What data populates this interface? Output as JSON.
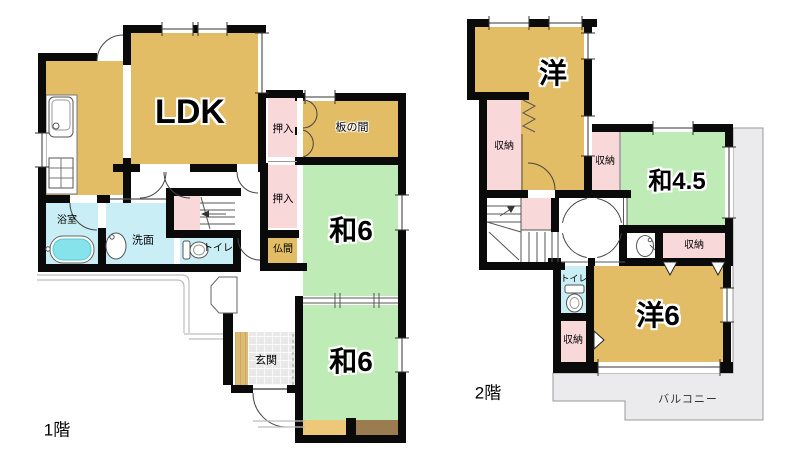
{
  "colors": {
    "wall": "#0a0a0a",
    "wood_tan": "#e3bc66",
    "tatami_green": "#bfecb6",
    "closet_pink": "#f9d8da",
    "wet_room_cyan": "#c9eef5",
    "bathtub_cyan": "#86e3eb",
    "balcony_gray": "#ebebed",
    "entrance_tile_gray": "#e9e9e9",
    "wood_strip_brown": "#9b7c50"
  },
  "floor1": {
    "floor_label": "1階",
    "rooms": {
      "ldk": "LDK",
      "itanoma": "板の間",
      "oshiire_upper": "押入",
      "oshiire_lower": "押入",
      "washitsu_east": "和6",
      "washitsu_south": "和6",
      "butsuma": "仏間",
      "bathroom": "浴室",
      "washroom": "洗面",
      "toilet": "トイレ",
      "genkan": "玄関"
    }
  },
  "floor2": {
    "floor_label": "2階",
    "rooms": {
      "yoshitsu": "洋",
      "shuno_stair": "収納",
      "shuno_center": "収納",
      "washitsu45": "和4.5",
      "shuno_hall": "収納",
      "toilet": "トイレ",
      "shuno_south": "収納",
      "yoshitsu6": "洋6",
      "balcony": "バルコニー"
    }
  }
}
